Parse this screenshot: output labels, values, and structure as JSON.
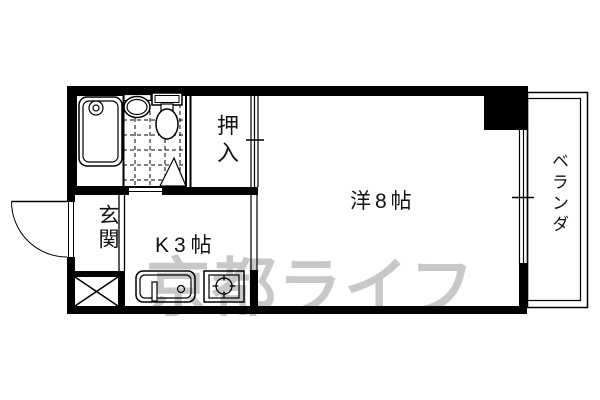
{
  "floorplan": {
    "labels": {
      "closet": "押入",
      "western_room": "洋8帖",
      "kitchen": "K3帖",
      "entrance": "玄関",
      "veranda": "ベランダ"
    },
    "watermark": "京都ライフ",
    "colors": {
      "wall": "#000000",
      "background": "#ffffff",
      "watermark": "#c8c8c8"
    }
  }
}
